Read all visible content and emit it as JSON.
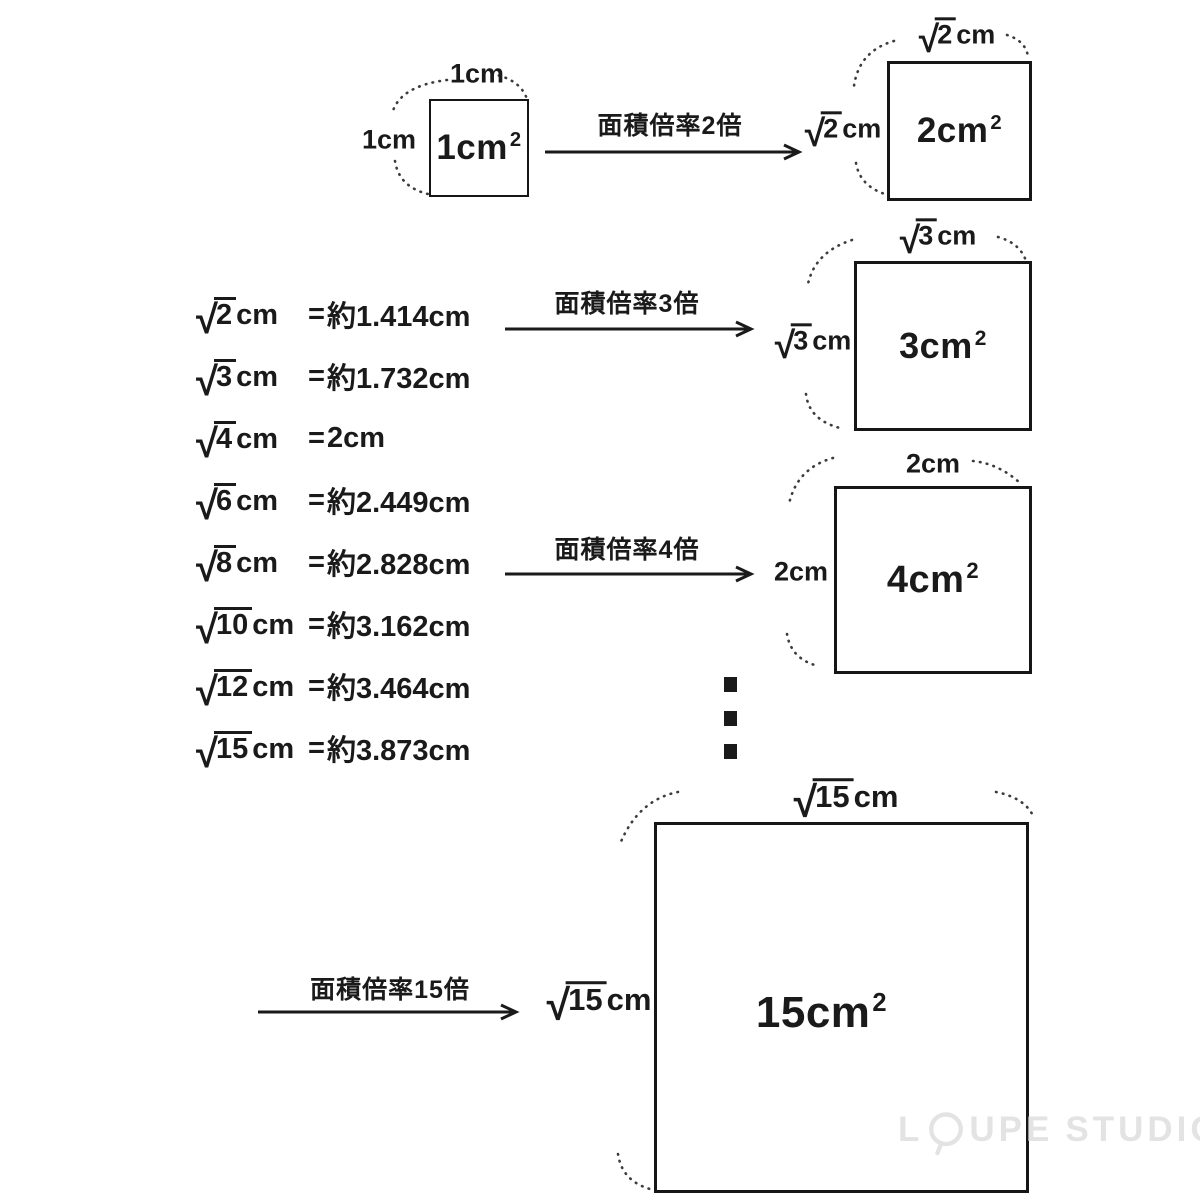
{
  "colors": {
    "ink": "#1a1a1a",
    "paper": "#ffffff",
    "watermark": "#e0e0e0"
  },
  "symbols": {
    "radical": "√"
  },
  "transformations": [
    {
      "arrow_label": "面積倍率2倍"
    },
    {
      "arrow_label": "面積倍率3倍"
    },
    {
      "arrow_label": "面積倍率4倍"
    },
    {
      "arrow_label": "面積倍率15倍"
    }
  ],
  "squares": {
    "s1": {
      "area_base": "1cm",
      "area_exp": "2",
      "top_text": "1cm",
      "left_text": "1cm"
    },
    "s2": {
      "area_base": "2cm",
      "area_exp": "2",
      "top_radicand": "2",
      "top_unit": "cm",
      "left_radicand": "2",
      "left_unit": "cm"
    },
    "s3": {
      "area_base": "3cm",
      "area_exp": "2",
      "top_radicand": "3",
      "top_unit": "cm",
      "left_radicand": "3",
      "left_unit": "cm"
    },
    "s4": {
      "area_base": "4cm",
      "area_exp": "2",
      "top_text": "2cm",
      "left_text": "2cm"
    },
    "s5": {
      "area_base": "15cm",
      "area_exp": "2",
      "top_radicand": "15",
      "top_unit": "cm",
      "left_radicand": "15",
      "left_unit": "cm"
    }
  },
  "sqrt_table": {
    "rows": [
      {
        "radicand": "2",
        "unit": "cm",
        "equals": "=",
        "result": "約1.414cm"
      },
      {
        "radicand": "3",
        "unit": "cm",
        "equals": "=",
        "result": "約1.732cm"
      },
      {
        "radicand": "4",
        "unit": "cm",
        "equals": "=",
        "result": "2cm"
      },
      {
        "radicand": "6",
        "unit": "cm",
        "equals": "=",
        "result": "約2.449cm"
      },
      {
        "radicand": "8",
        "unit": "cm",
        "equals": "=",
        "result": "約2.828cm"
      },
      {
        "radicand": "10",
        "unit": "cm",
        "equals": "=",
        "result": "約3.162cm"
      },
      {
        "radicand": "12",
        "unit": "cm",
        "equals": "=",
        "result": "約3.464cm"
      },
      {
        "radicand": "15",
        "unit": "cm",
        "equals": "=",
        "result": "約3.873cm"
      }
    ]
  },
  "ellipsis_dots": 3,
  "watermark": {
    "part1": "L",
    "part2": "UPE",
    "part3": "STUDIO",
    "icon": "loupe-icon"
  }
}
